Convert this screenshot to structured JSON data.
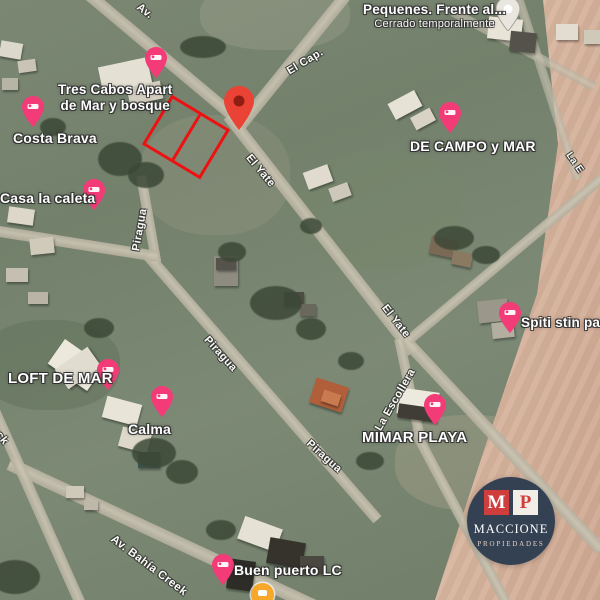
{
  "map_type": "satellite",
  "places": [
    {
      "lines": [
        "Pequenes. Frente al..."
      ],
      "status": "Cerrado temporalmente",
      "pin": "place-pin-gray"
    },
    {
      "lines": [
        "Tres Cabos Apart",
        "de Mar y bosque"
      ],
      "pin": "lodging-pin-pink"
    },
    {
      "lines": [
        "Costa Brava"
      ],
      "pin": "lodging-pin-pink"
    },
    {
      "lines": [
        "Casa la caleta"
      ],
      "pin": "lodging-pin-pink"
    },
    {
      "lines": [
        "DE CAMPO y MAR"
      ],
      "pin": "lodging-pin-pink"
    },
    {
      "lines": [
        "Spiti stin para"
      ],
      "pin": "lodging-pin-pink"
    },
    {
      "lines": [
        "LOFT DE MAR"
      ],
      "pin": "lodging-pin-pink"
    },
    {
      "lines": [
        "Calma"
      ],
      "pin": "lodging-pin-pink"
    },
    {
      "lines": [
        "MIMAR PLAYA"
      ],
      "pin": "lodging-pin-pink"
    },
    {
      "lines": [
        "Buen puerto LC"
      ],
      "pin": "lodging-pin-pink"
    }
  ],
  "streets": [
    {
      "name": "Av."
    },
    {
      "name": "El Cap."
    },
    {
      "name": "El Yate"
    },
    {
      "name": "El Yate"
    },
    {
      "name": "Piragua"
    },
    {
      "name": "Piragua"
    },
    {
      "name": "Piragua"
    },
    {
      "name": "La Escollera"
    },
    {
      "name": "Av. Bahía Creek"
    },
    {
      "name": "eck"
    },
    {
      "name": "La E"
    }
  ],
  "markers": {
    "selected_property_pin": "red-map-pin",
    "property_outline": {
      "lots": 2,
      "color": "#ee1111"
    },
    "orange_marker": "orange-dot"
  },
  "logo": {
    "monogram": [
      "M",
      "P"
    ],
    "name": "MACCIONE",
    "subtitle": "PROPIEDADES"
  },
  "colors": {
    "grass": "#76836e",
    "road": "#c1bbab",
    "sand": "#d0b49d",
    "pin_pink": "#f23b77",
    "pin_red": "#ea4335",
    "logo_navy": "#2d3c50",
    "logo_red": "#cf3d3d",
    "outline_red": "#ee1111",
    "orange": "#f7a82a"
  }
}
